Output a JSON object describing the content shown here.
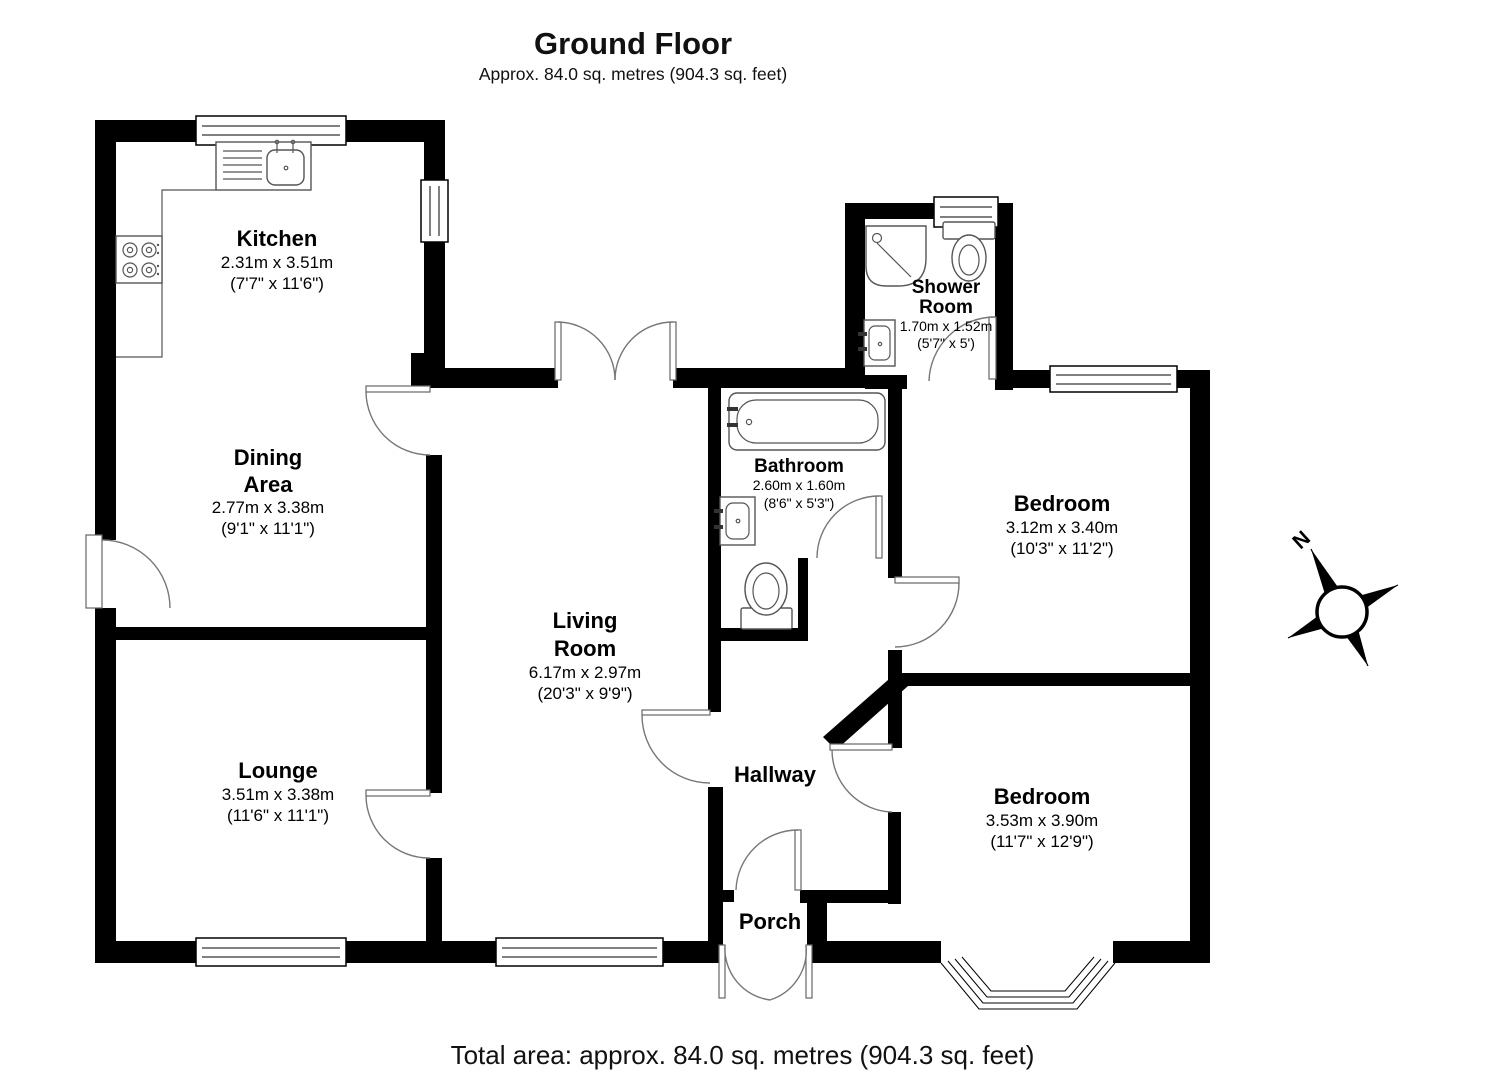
{
  "title": "Ground Floor",
  "subtitle": "Approx. 84.0 sq. metres (904.3 sq. feet)",
  "total": "Total area: approx. 84.0 sq. metres (904.3 sq. feet)",
  "compass": {
    "north_label": "N"
  },
  "colors": {
    "wall": "#000000",
    "fixture_line": "#555555",
    "door_arc": "#777777"
  },
  "rooms": {
    "kitchen": {
      "name": "Kitchen",
      "metric": "2.31m x 3.51m",
      "imperial": "(7'7\" x 11'6\")"
    },
    "dining": {
      "name_line1": "Dining",
      "name_line2": "Area",
      "metric": "2.77m x 3.38m",
      "imperial": "(9'1\" x 11'1\")"
    },
    "lounge": {
      "name": "Lounge",
      "metric": "3.51m x 3.38m",
      "imperial": "(11'6\" x 11'1\")"
    },
    "living": {
      "name_line1": "Living",
      "name_line2": "Room",
      "metric": "6.17m x 2.97m",
      "imperial": "(20'3\" x 9'9\")"
    },
    "bathroom": {
      "name": "Bathroom",
      "metric": "2.60m x 1.60m",
      "imperial": "(8'6\" x 5'3\")"
    },
    "shower": {
      "name_line1": "Shower",
      "name_line2": "Room",
      "metric": "1.70m x 1.52m",
      "imperial": "(5'7\" x 5')"
    },
    "bedroom1": {
      "name": "Bedroom",
      "metric": "3.12m x 3.40m",
      "imperial": "(10'3\" x 11'2\")"
    },
    "bedroom2": {
      "name": "Bedroom",
      "metric": "3.53m x 3.90m",
      "imperial": "(11'7\" x 12'9\")"
    },
    "hallway": {
      "name": "Hallway"
    },
    "porch": {
      "name": "Porch"
    }
  }
}
